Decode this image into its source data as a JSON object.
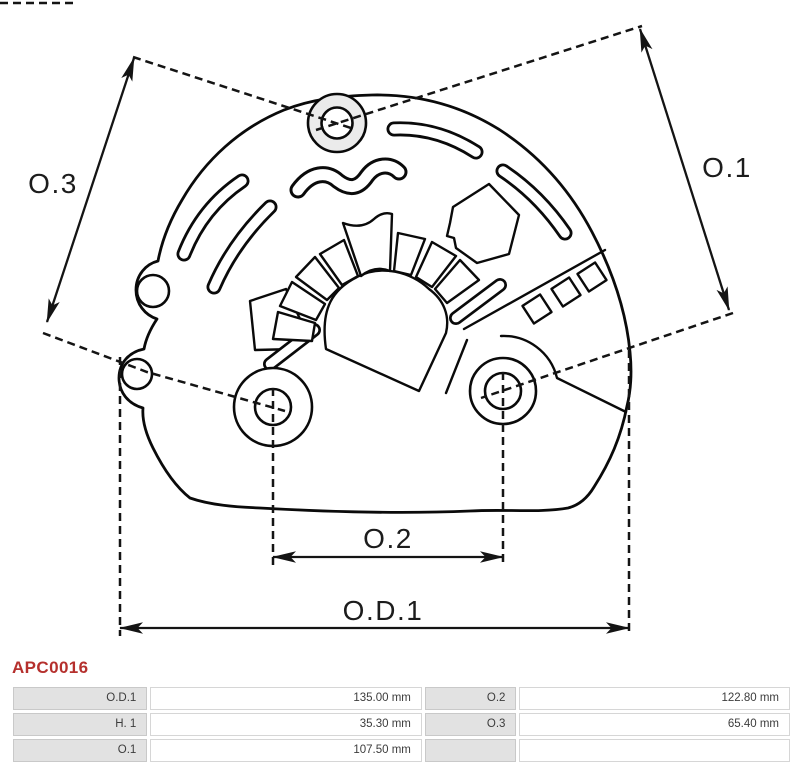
{
  "part_number": "APC0016",
  "drawing": {
    "labels": {
      "o3": "O.3",
      "o1": "O.1",
      "o2": "O.2",
      "od1": "O.D.1"
    }
  },
  "table": {
    "rows": [
      {
        "c1": "O.D.1",
        "v1": "135.00 mm",
        "c2": "O.2",
        "v2": "122.80 mm"
      },
      {
        "c1": "H. 1",
        "v1": "35.30 mm",
        "c2": "O.3",
        "v2": "65.40 mm"
      },
      {
        "c1": "O.1",
        "v1": "107.50 mm",
        "c2": "",
        "v2": ""
      }
    ]
  },
  "colors": {
    "accent_red": "#b5302d",
    "table_label_bg": "#e2e2e2",
    "line_black": "#0a0a0a",
    "boss_gray": "#ebebeb"
  }
}
